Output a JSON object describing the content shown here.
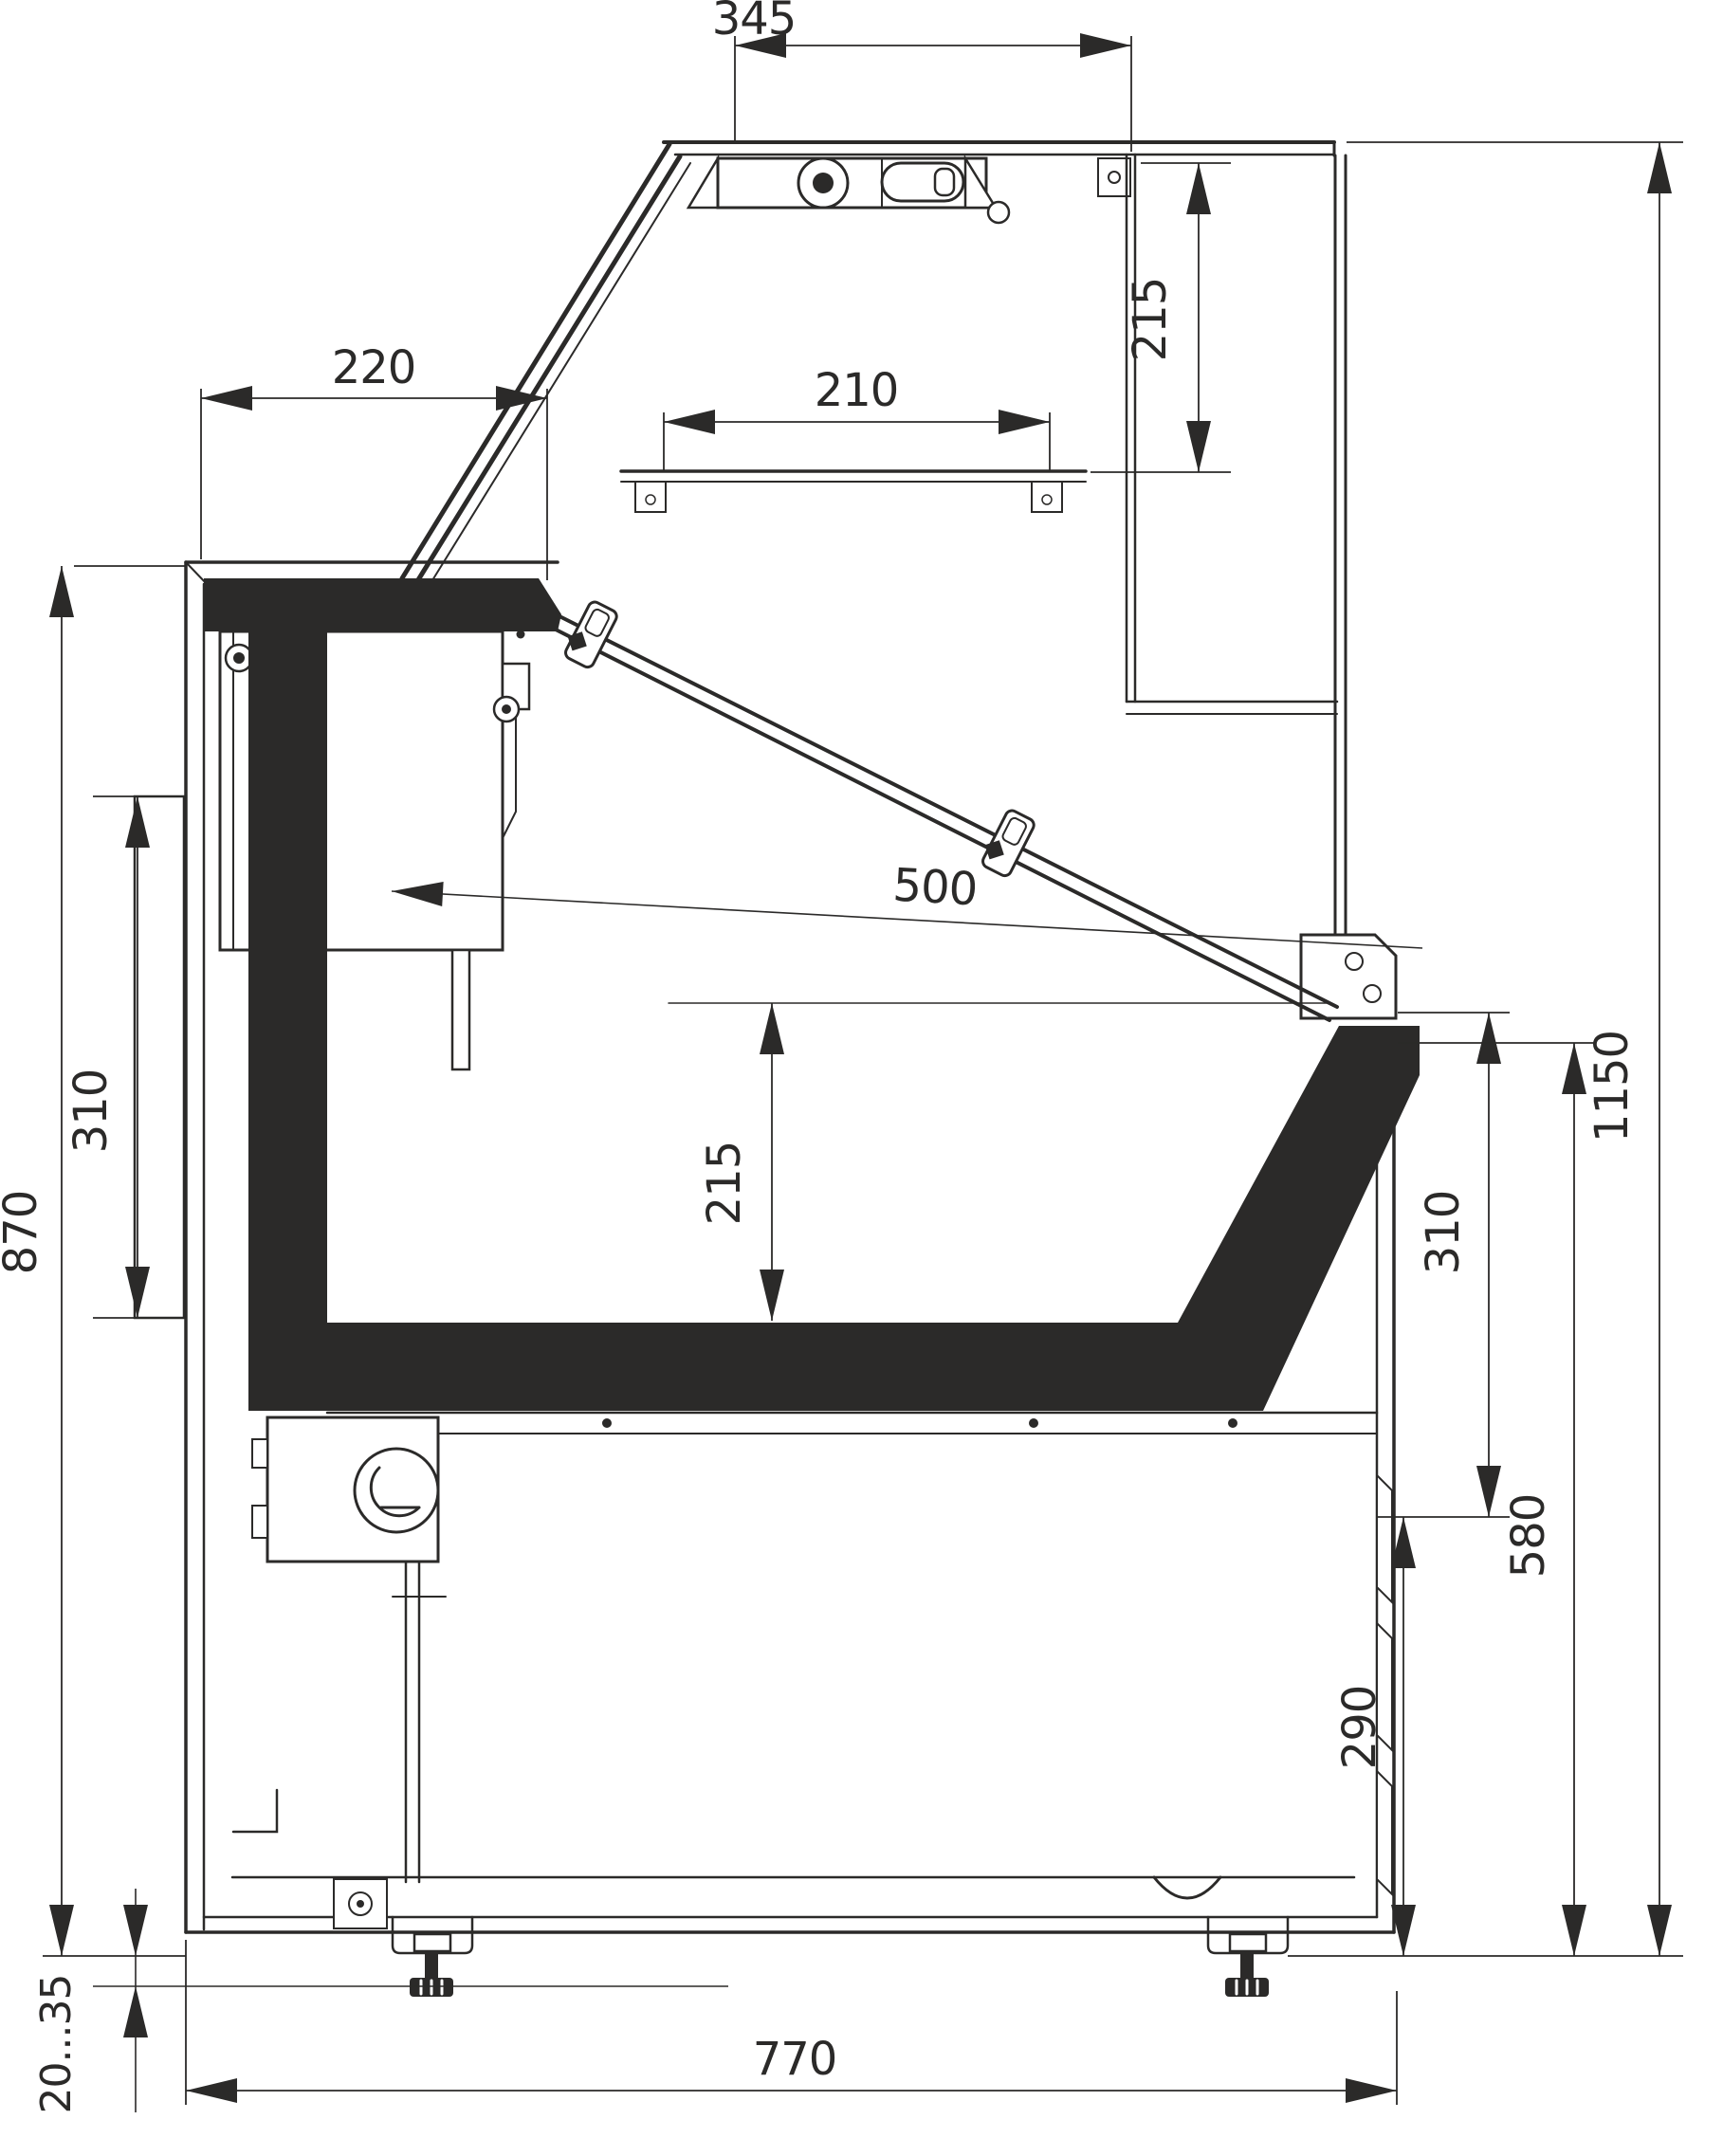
{
  "drawing": {
    "kind": "technical-cross-section",
    "subject": "refrigerated-display-counter-side-section",
    "line_color": "#2b2a29",
    "background_color": "#ffffff",
    "dims": {
      "d345": "345",
      "d215_top": "215",
      "d220": "220",
      "d210": "210",
      "d500": "500",
      "d310_left": "310",
      "d870": "870",
      "d215_mid": "215",
      "d1150": "1150",
      "d310_right": "310",
      "d580": "580",
      "d290": "290",
      "d770": "770",
      "d_foot_adjust": "20...35"
    }
  }
}
